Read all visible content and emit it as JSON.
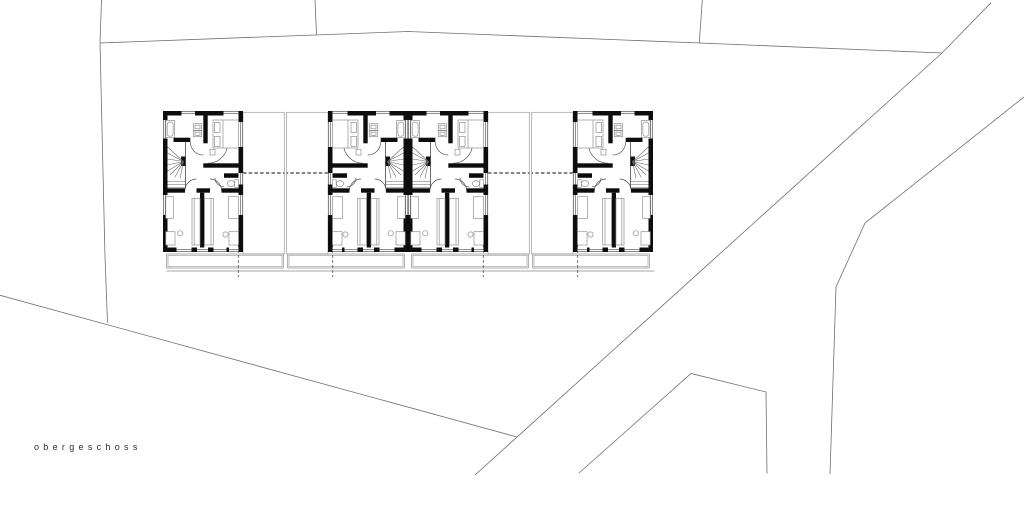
{
  "plan": {
    "floor_label": "obergeschoss",
    "drawing_type": "floor plan",
    "units_count": 4,
    "mirrored_units": [
      2,
      4
    ],
    "colors": {
      "background": "#ffffff",
      "wall": "#0d0d0d",
      "thin_line": "#565656",
      "furniture_line": "#8f8f8f",
      "site_line": "#6f6f6f",
      "outline_line": "#8a8a8a",
      "dashed_line": "#3c3c3c",
      "label_text": "#2e2e2e"
    }
  }
}
